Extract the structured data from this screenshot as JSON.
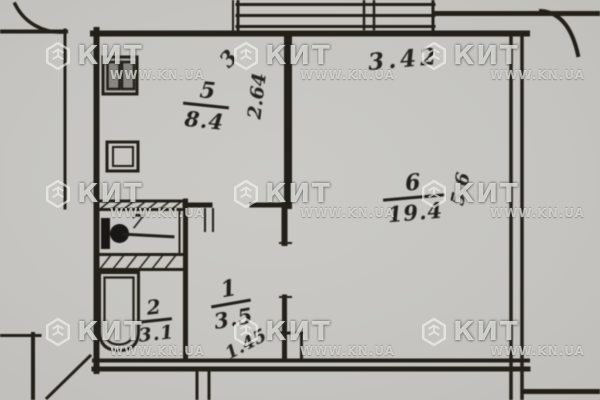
{
  "watermark": {
    "brand": "КИТ",
    "site": "WWW.KN.UA"
  },
  "floorplan": {
    "rooms": {
      "kitchen": {
        "number": "5",
        "area": "8.4"
      },
      "living": {
        "number": "6",
        "area": "19.4"
      },
      "toilet": {
        "number": "7",
        "area": ""
      },
      "bathroom": {
        "number": "2",
        "area": "3.1"
      },
      "hallway": {
        "number": "1",
        "area": "3.5"
      }
    },
    "dimensions": {
      "living_width": "3.42",
      "living_depth": "5.6",
      "kitchen_depth": "2.64",
      "kitchen_width": "3",
      "hallway_width": "1.45"
    }
  }
}
